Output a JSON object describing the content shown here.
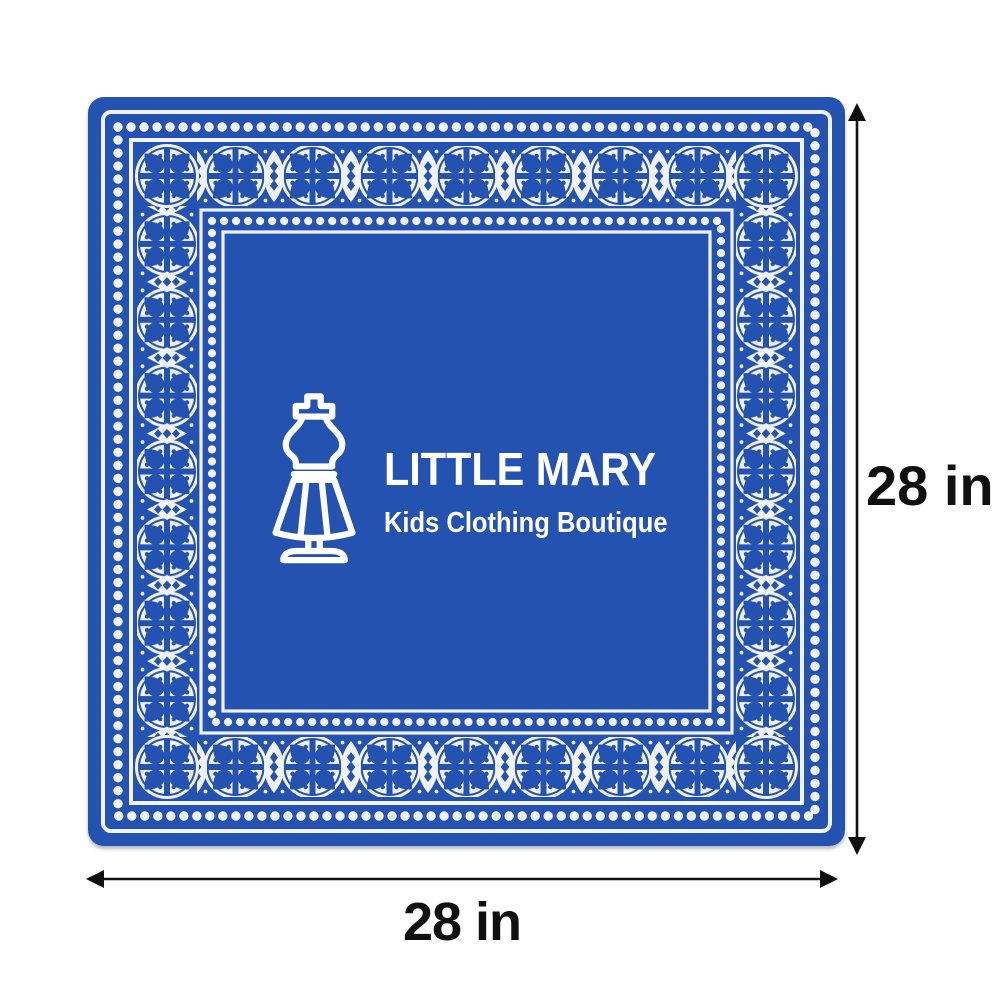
{
  "logo": {
    "title": "LITTLE MARY",
    "subtitle": "Kids Clothing Boutique",
    "icon": "dress-form-mannequin-icon"
  },
  "dimensions": {
    "height_label": "28 in",
    "width_label": "28 in"
  },
  "colors": {
    "bandana_blue": "#2452b0",
    "pattern_white": "#f1f3f8",
    "label_text": "#101010",
    "background": "#ffffff"
  }
}
